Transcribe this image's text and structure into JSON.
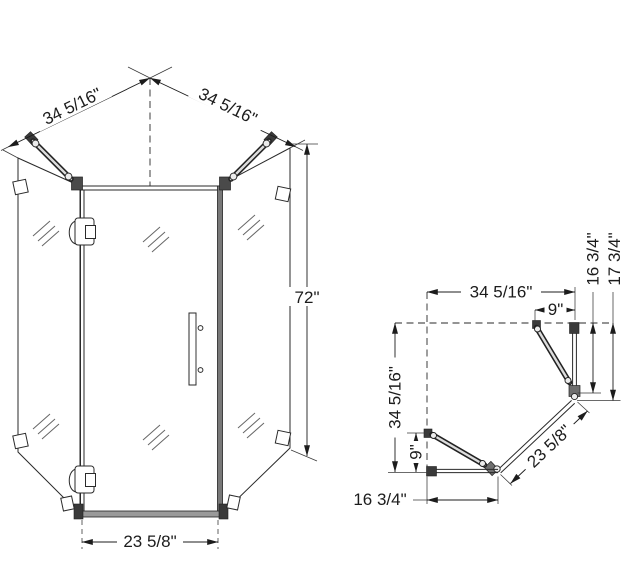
{
  "front_view": {
    "width_left": "34 5/16\"",
    "width_right": "34 5/16\"",
    "height": "72\"",
    "door_width": "23 5/8\""
  },
  "plan_view": {
    "width_top": "34 5/16\"",
    "panel_offset_top": "9\"",
    "panel_right": "16 3/4\"",
    "total_right": "17 3/4\"",
    "width_left": "34 5/16\"",
    "panel_offset_left": "9\"",
    "panel_bottom": "16 3/4\"",
    "door": "23 5/8\""
  }
}
